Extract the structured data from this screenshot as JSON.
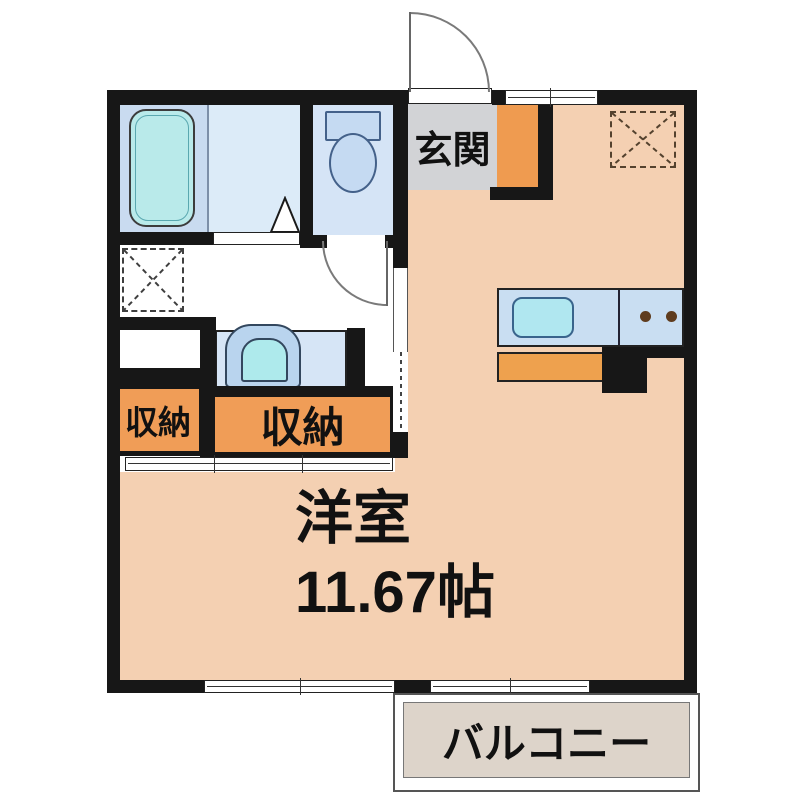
{
  "floorplan": {
    "rooms": {
      "entrance_label": "玄関",
      "storage_left_label": "収納",
      "storage_right_label": "収納",
      "western_room_label": "洋室",
      "western_room_size": "11.67帖",
      "balcony_label": "バルコニー"
    },
    "colors": {
      "wall": "#171717",
      "floor_peach": "#f4d0b2",
      "entrance_gray": "#d2d3d6",
      "storage_orange": "#f09d57",
      "kitchen_cabinet_orange": "#eea14e",
      "kitchen_counter_blue": "#c9def2",
      "sink_cyan": "#b0e7f0",
      "bathroom_blue": "#c9dbf0",
      "shower_room_blue": "#dcebf8",
      "toilet_room_blue": "#d5e4f6",
      "bathtub_cyan": "#b9eaea",
      "balcony_gray": "#ddd4ca",
      "burner_brown": "#5f3c1e"
    },
    "icons": {
      "bathtub": "bathtub-icon",
      "toilet": "toilet-icon",
      "washbasin": "washbasin-icon",
      "kitchen_sink": "kitchen-sink-icon",
      "stove_burners": "stove-burners-icon",
      "washing_machine_space": "washing-machine-space-icon",
      "refrigerator_space": "refrigerator-space-icon",
      "entrance_door": "entrance-door-swing-icon",
      "toilet_door": "toilet-door-swing-icon",
      "sliding_partition": "sliding-partition-icon"
    }
  }
}
